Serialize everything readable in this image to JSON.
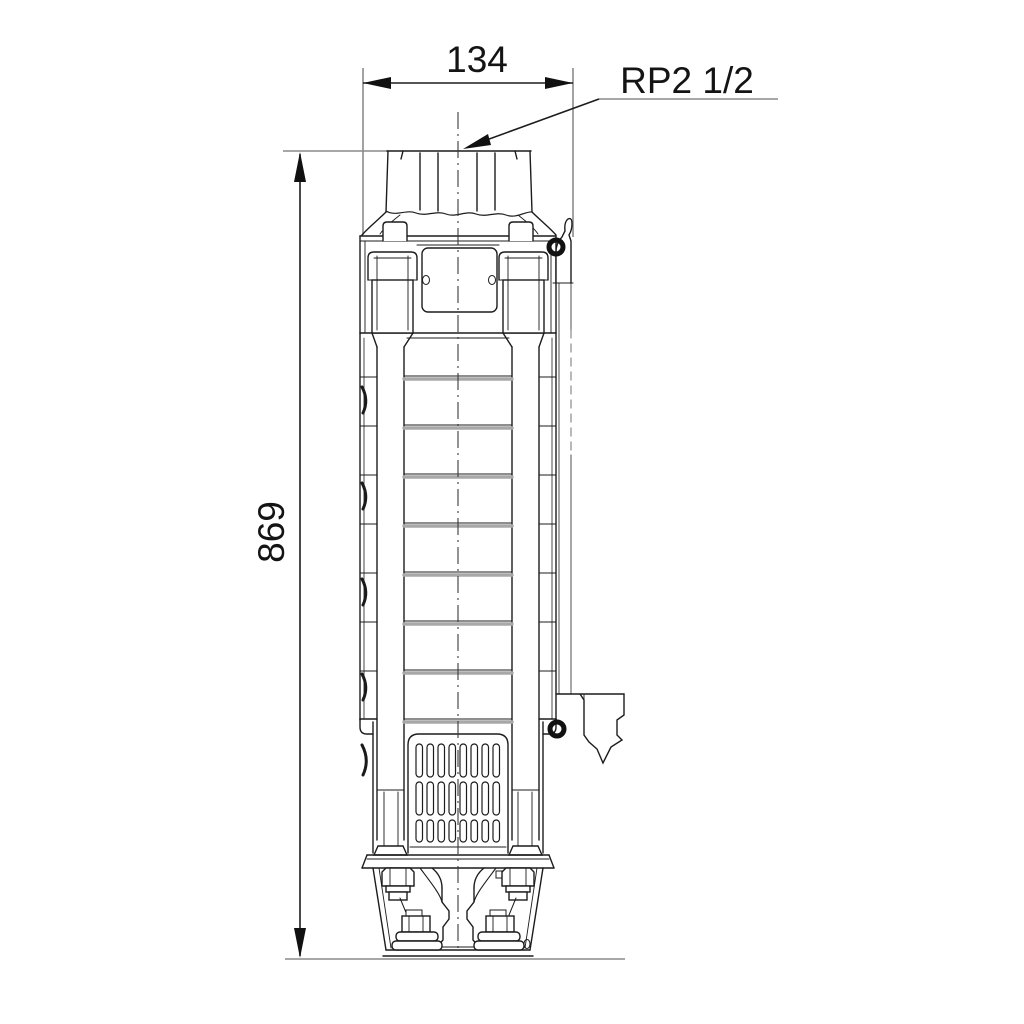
{
  "drawing": {
    "dim_width_label": "134",
    "dim_height_label": "869",
    "connection_label": "RP2 1/2",
    "bottom_mark": "0",
    "colors": {
      "background": "#ffffff",
      "main_line": "#1c1c1c",
      "aux_line": "#8a8a8a",
      "joint_line": "#a8a8a8"
    }
  }
}
